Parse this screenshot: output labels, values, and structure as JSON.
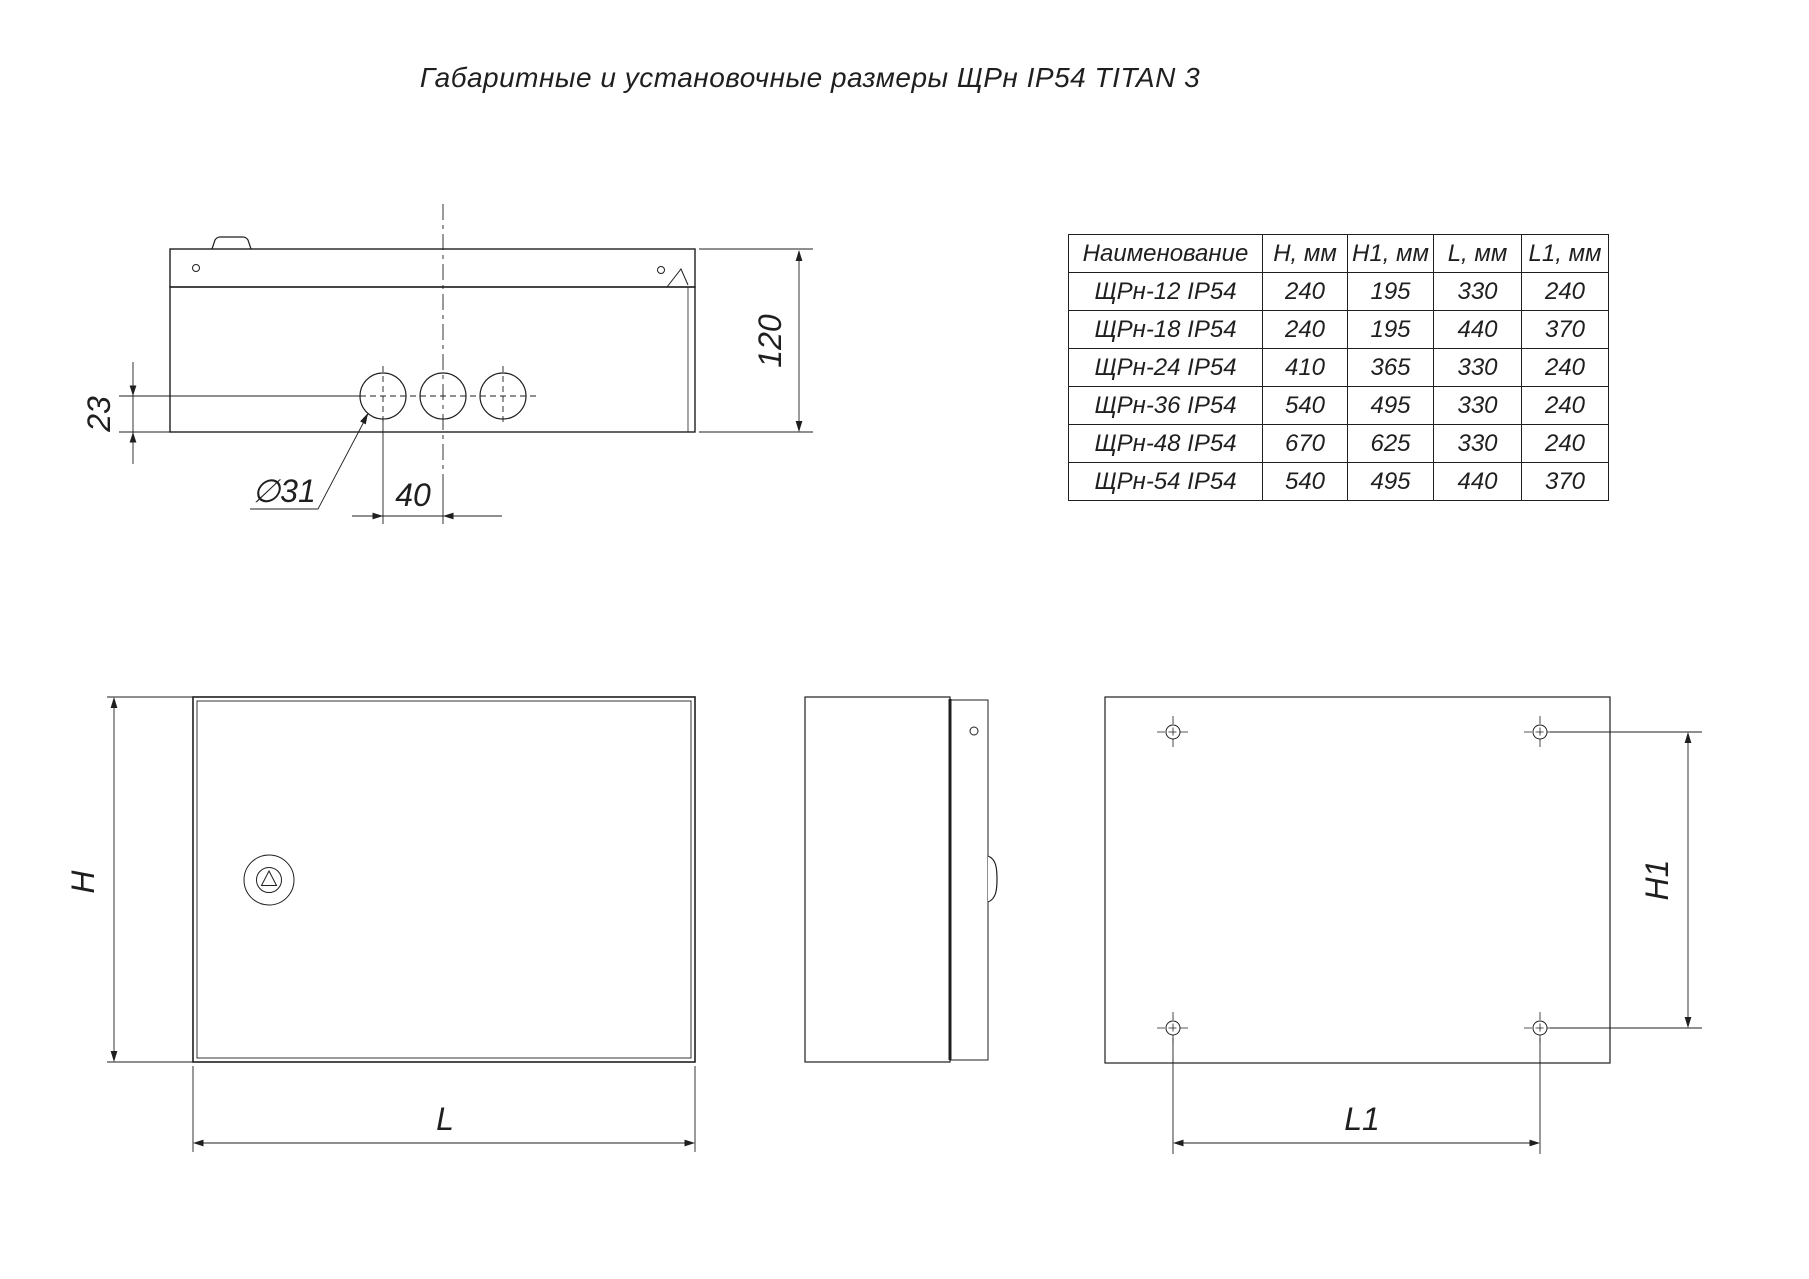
{
  "title": "Габаритные и установочные размеры ЩРн IP54 TITAN 3",
  "table": {
    "headers": [
      "Наименование",
      "H, мм",
      "H1, мм",
      "L, мм",
      "L1, мм"
    ],
    "rows": [
      [
        "ЩРн-12 IP54",
        "240",
        "195",
        "330",
        "240"
      ],
      [
        "ЩРн-18 IP54",
        "240",
        "195",
        "440",
        "370"
      ],
      [
        "ЩРн-24 IP54",
        "410",
        "365",
        "330",
        "240"
      ],
      [
        "ЩРн-36 IP54",
        "540",
        "495",
        "330",
        "240"
      ],
      [
        "ЩРн-48 IP54",
        "670",
        "625",
        "330",
        "240"
      ],
      [
        "ЩРн-54 IP54",
        "540",
        "495",
        "440",
        "370"
      ]
    ]
  },
  "dimensions": {
    "top_view": {
      "depth": "120",
      "hole_offset": "23",
      "hole_diameter": "∅31",
      "hole_spacing": "40"
    },
    "front_view": {
      "height": "H",
      "width": "L"
    },
    "rear_view": {
      "mount_height": "H1",
      "mount_width": "L1"
    }
  },
  "colors": {
    "line": "#1f1f1f",
    "background": "#ffffff"
  }
}
